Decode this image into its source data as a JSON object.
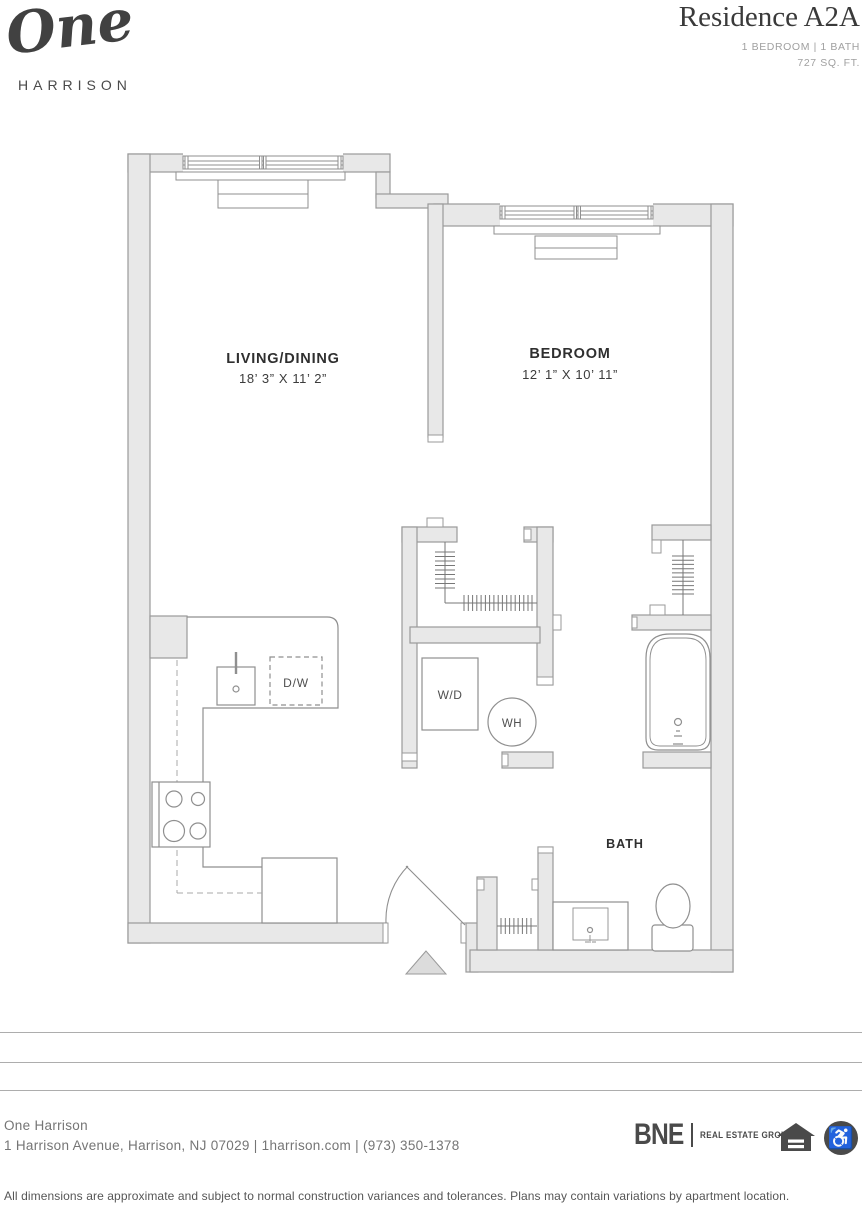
{
  "header": {
    "logo_script": "One",
    "logo_sub": "HARRISON",
    "residence": "Residence A2A",
    "bed_bath": "1 BEDROOM | 1 BATH",
    "sqft": "727 SQ. FT."
  },
  "plan": {
    "living_name": "LIVING/DINING",
    "living_dims": "18’ 3” X 11’ 2”",
    "bedroom_name": "BEDROOM",
    "bedroom_dims": "12’ 1” X 10’ 11”",
    "bath_name": "BATH",
    "washer_dryer": "W/D",
    "water_heater": "WH",
    "dishwasher": "D/W"
  },
  "footer": {
    "property": "One Harrison",
    "address": "1 Harrison Avenue, Harrison, NJ 07029 | 1harrison.com | (973) 350-1378",
    "disclaimer": "All dimensions are approximate and subject to normal construction variances and tolerances. Plans may contain variations by apartment location.",
    "bne": "BNE",
    "bne_sub": "REAL ESTATE GROUP"
  },
  "icons": {
    "accessibility": "♿"
  },
  "colors": {
    "wall_fill": "#e8e8e8",
    "wall_stroke": "#9a9a9a",
    "fixture_stroke": "#8f8f8f",
    "text_dark": "#2f2f2f",
    "text_gray": "#757575",
    "logo_dark": "#4a4a4a"
  }
}
